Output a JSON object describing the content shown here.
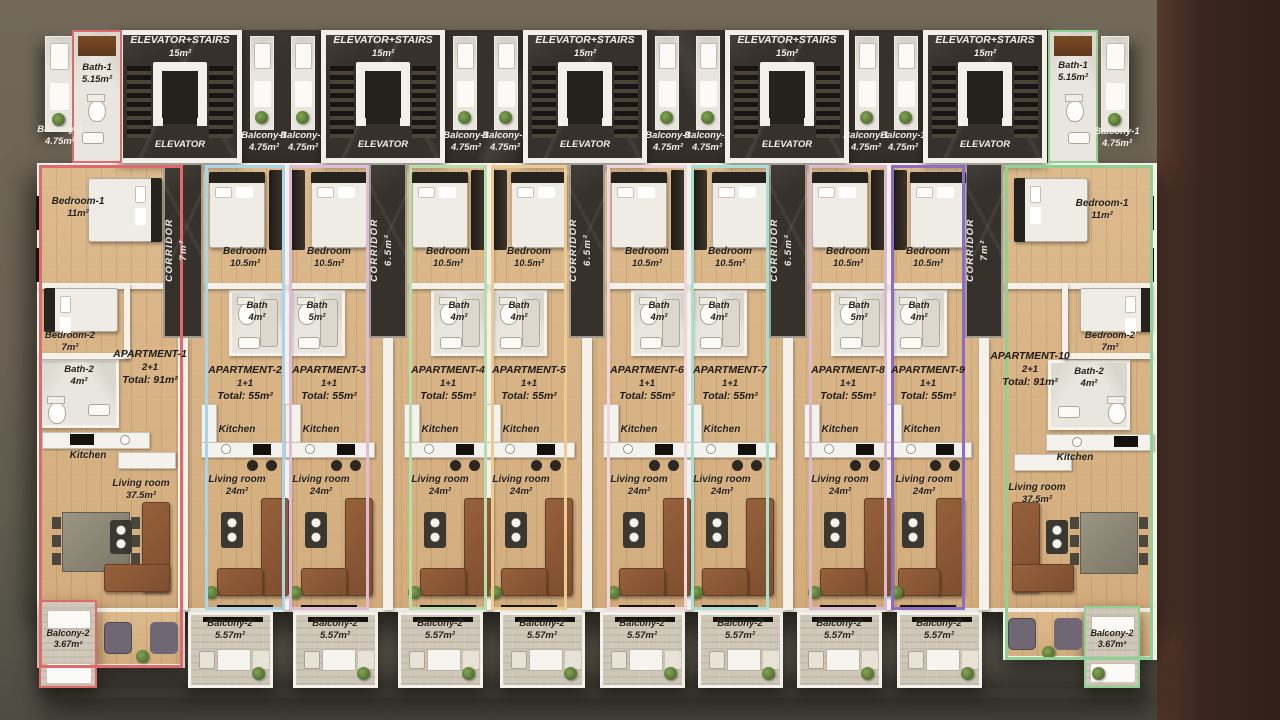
{
  "scene": {
    "background": "#6b6254",
    "side_panel": "#3a2620",
    "wall": "#f4f1ea",
    "floor_wood": "#d8b486",
    "accent_marble": "#37312b"
  },
  "shared": {
    "elevator_stairs": "ELEVATOR+STAIRS",
    "elevator_stairs_area": "15m²",
    "elevator": "ELEVATOR",
    "corridor": "CORRIDOR",
    "balcony1": "Balcony-1",
    "balcony1_area": "4.75m²",
    "kitchen": "Kitchen"
  },
  "corridors": [
    {
      "area": "7m²"
    },
    {
      "area": "6.5m²"
    },
    {
      "area": "6.5m²"
    },
    {
      "area": "6.5m²"
    },
    {
      "area": "7m²"
    }
  ],
  "apartments": [
    {
      "name": "APARTMENT-1",
      "type": "2+1",
      "total": "Total: 91m²",
      "outline": "#e0696b",
      "bath1": "Bath-1",
      "bath1_area": "5.15m²",
      "bedroom1": "Bedroom-1",
      "bedroom1_area": "11m²",
      "bedroom2": "Bedroom-2",
      "bedroom2_area": "7m²",
      "bath2": "Bath-2",
      "bath2_area": "4m²",
      "living": "Living room",
      "living_area": "37.5m²",
      "balcony2": "Balcony-2",
      "balcony2_area": "3.67m²"
    },
    {
      "name": "APARTMENT-2",
      "type": "1+1",
      "total": "Total: 55m²",
      "outline": "#a9d4e9",
      "bedroom": "Bedroom",
      "bedroom_area": "10.5m²",
      "bath": "Bath",
      "bath_area": "4m²",
      "living": "Living room",
      "living_area": "24m²",
      "balcony2": "Balcony-2",
      "balcony2_area": "5.57m²"
    },
    {
      "name": "APARTMENT-3",
      "type": "1+1",
      "total": "Total: 55m²",
      "outline": "#dfbbd4",
      "bedroom": "Bedroom",
      "bedroom_area": "10.5m²",
      "bath": "Bath",
      "bath_area": "5m²",
      "living": "Living room",
      "living_area": "24m²",
      "balcony2": "Balcony-2",
      "balcony2_area": "5.57m²"
    },
    {
      "name": "APARTMENT-4",
      "type": "1+1",
      "total": "Total: 55m²",
      "outline": "#b8dcab",
      "bedroom": "Bedroom",
      "bedroom_area": "10.5m²",
      "bath": "Bath",
      "bath_area": "4m²",
      "living": "Living room",
      "living_area": "24m²",
      "balcony2": "Balcony-2",
      "balcony2_area": "5.57m²"
    },
    {
      "name": "APARTMENT-5",
      "type": "1+1",
      "total": "Total: 55m²",
      "outline": "#eccb93",
      "bedroom": "Bedroom",
      "bedroom_area": "10.5m²",
      "bath": "Bath",
      "bath_area": "4m²",
      "living": "Living room",
      "living_area": "24m²",
      "balcony2": "Balcony-2",
      "balcony2_area": "5.57m²"
    },
    {
      "name": "APARTMENT-6",
      "type": "1+1",
      "total": "Total: 55m²",
      "outline": "#f0d6da",
      "bedroom": "Bedroom",
      "bedroom_area": "10.5m²",
      "bath": "Bath",
      "bath_area": "4m²",
      "living": "Living room",
      "living_area": "24m²",
      "balcony2": "Balcony-2",
      "balcony2_area": "5.57m²"
    },
    {
      "name": "APARTMENT-7",
      "type": "1+1",
      "total": "Total: 55m²",
      "outline": "#a9dfd2",
      "bedroom": "Bedroom",
      "bedroom_area": "10.5m²",
      "bath": "Bath",
      "bath_area": "4m²",
      "living": "Living room",
      "living_area": "24m²",
      "balcony2": "Balcony-2",
      "balcony2_area": "5.57m²"
    },
    {
      "name": "APARTMENT-8",
      "type": "1+1",
      "total": "Total: 55m²",
      "outline": "#d9b9cb",
      "bedroom": "Bedroom",
      "bedroom_area": "10.5m²",
      "bath": "Bath",
      "bath_area": "5m²",
      "living": "Living room",
      "living_area": "24m²",
      "balcony2": "Balcony-2",
      "balcony2_area": "5.57m²"
    },
    {
      "name": "APARTMENT-9",
      "type": "1+1",
      "total": "Total: 55m²",
      "outline": "#8e6cc4",
      "bedroom": "Bedroom",
      "bedroom_area": "10.5m²",
      "bath": "Bath",
      "bath_area": "4m²",
      "living": "Living room",
      "living_area": "24m²",
      "balcony2": "Balcony-2",
      "balcony2_area": "5.57m²"
    },
    {
      "name": "APARTMENT-10",
      "type": "2+1",
      "total": "Total: 91m²",
      "outline": "#8ed193",
      "bath1": "Bath-1",
      "bath1_area": "5.15m²",
      "bedroom1": "Bedroom-1",
      "bedroom1_area": "11m²",
      "bedroom2": "Bedroom-2",
      "bedroom2_area": "7m²",
      "bath2": "Bath-2",
      "bath2_area": "4m²",
      "living": "Living room",
      "living_area": "37.5m²",
      "balcony2": "Balcony-2",
      "balcony2_area": "3.67m²"
    }
  ]
}
